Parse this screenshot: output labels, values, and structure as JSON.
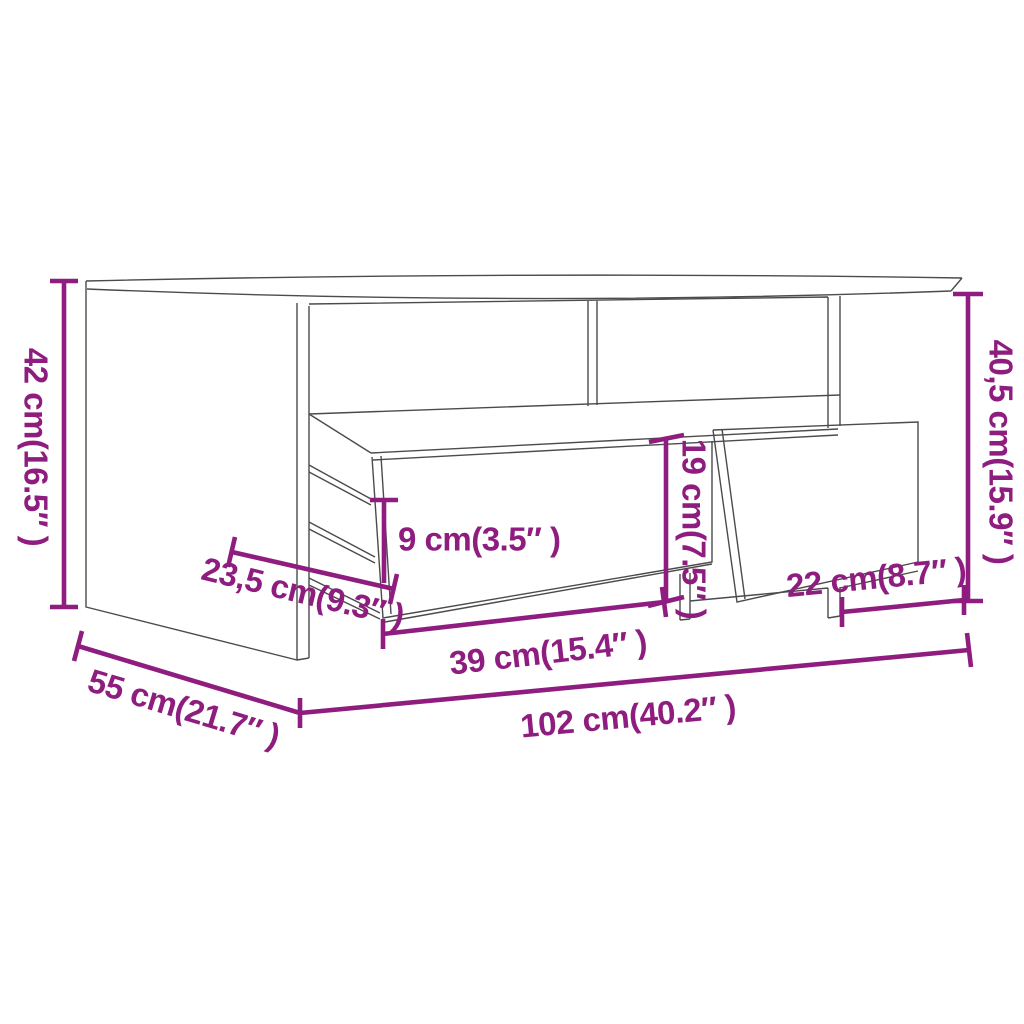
{
  "colors": {
    "accent": "#8E1D7F",
    "drawing_line": "#4B4B4B",
    "background": "#FFFFFF"
  },
  "diagram": {
    "kind": "furniture-dimension-diagram",
    "subject": "coffee table with open shelf and two drawers"
  },
  "dimensions": [
    {
      "id": "overall-height-left",
      "label": "42 cm(16.5″ )",
      "value_cm": 42,
      "value_in": 16.5
    },
    {
      "id": "top-depth",
      "label": "23,5 cm(9.3″ )",
      "value_cm": 23.5,
      "value_in": 9.3
    },
    {
      "id": "drawer-front-height",
      "label": "9 cm(3.5″ )",
      "value_cm": 9,
      "value_in": 3.5
    },
    {
      "id": "shelf-opening-height",
      "label": "19 cm(7.5″ )",
      "value_cm": 19,
      "value_in": 7.5
    },
    {
      "id": "overall-height-right",
      "label": "40,5 cm(15.9″ )",
      "value_cm": 40.5,
      "value_in": 15.9
    },
    {
      "id": "right-drawer-width",
      "label": "22 cm(8.7″ )",
      "value_cm": 22,
      "value_in": 8.7
    },
    {
      "id": "left-drawer-width",
      "label": "39 cm(15.4″ )",
      "value_cm": 39,
      "value_in": 15.4
    },
    {
      "id": "overall-depth",
      "label": "55 cm(21.7″ )",
      "value_cm": 55,
      "value_in": 21.7
    },
    {
      "id": "overall-width",
      "label": "102 cm(40.2″ )",
      "value_cm": 102,
      "value_in": 40.2
    }
  ]
}
